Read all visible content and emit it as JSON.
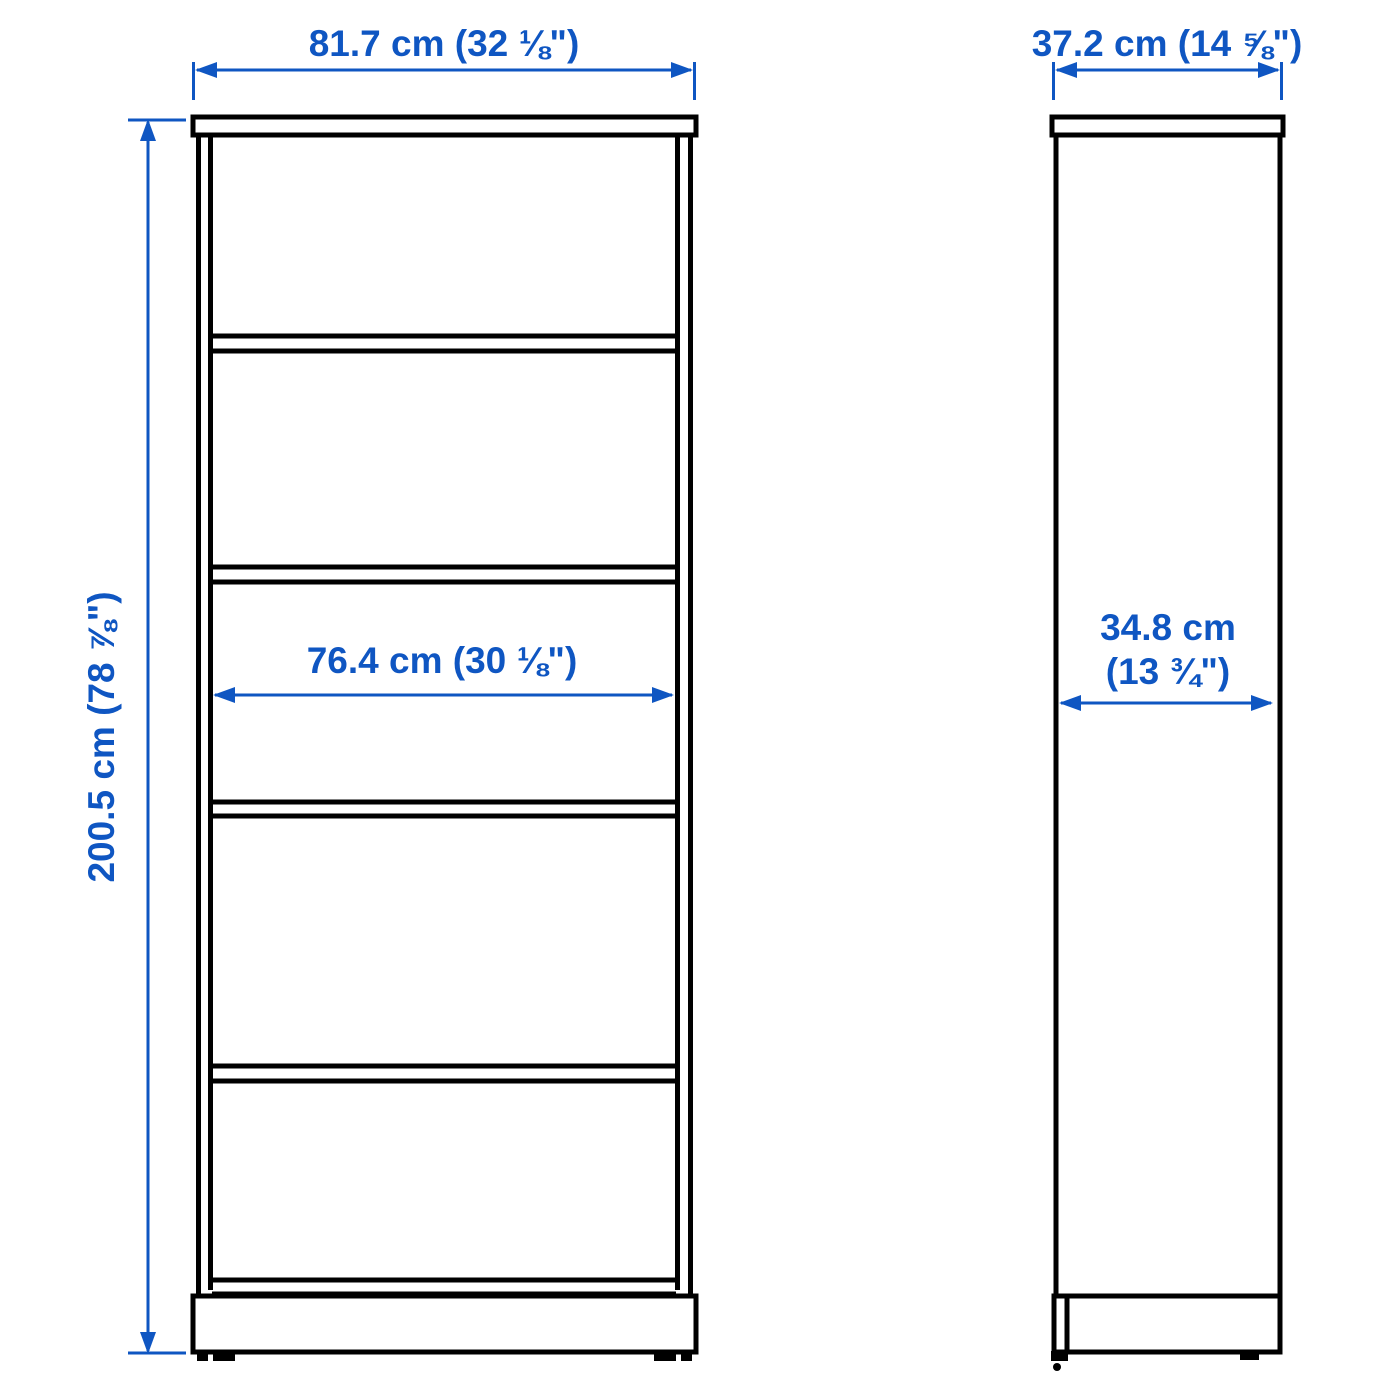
{
  "colors": {
    "accent": "#0f56c2",
    "line": "#000000",
    "background": "#ffffff"
  },
  "front_view": {
    "width_dim_label": "81.7 cm (32 ⅛\")",
    "height_dim_label": "200.5 cm (78 ⅞\")",
    "inner_width_dim_label": "76.4 cm (30 ⅛\")"
  },
  "side_view": {
    "depth_dim_label": "37.2 cm (14 ⅝\")",
    "inner_depth_dim_label_line1": "34.8 cm",
    "inner_depth_dim_label_line2": "(13 ¾\")"
  }
}
